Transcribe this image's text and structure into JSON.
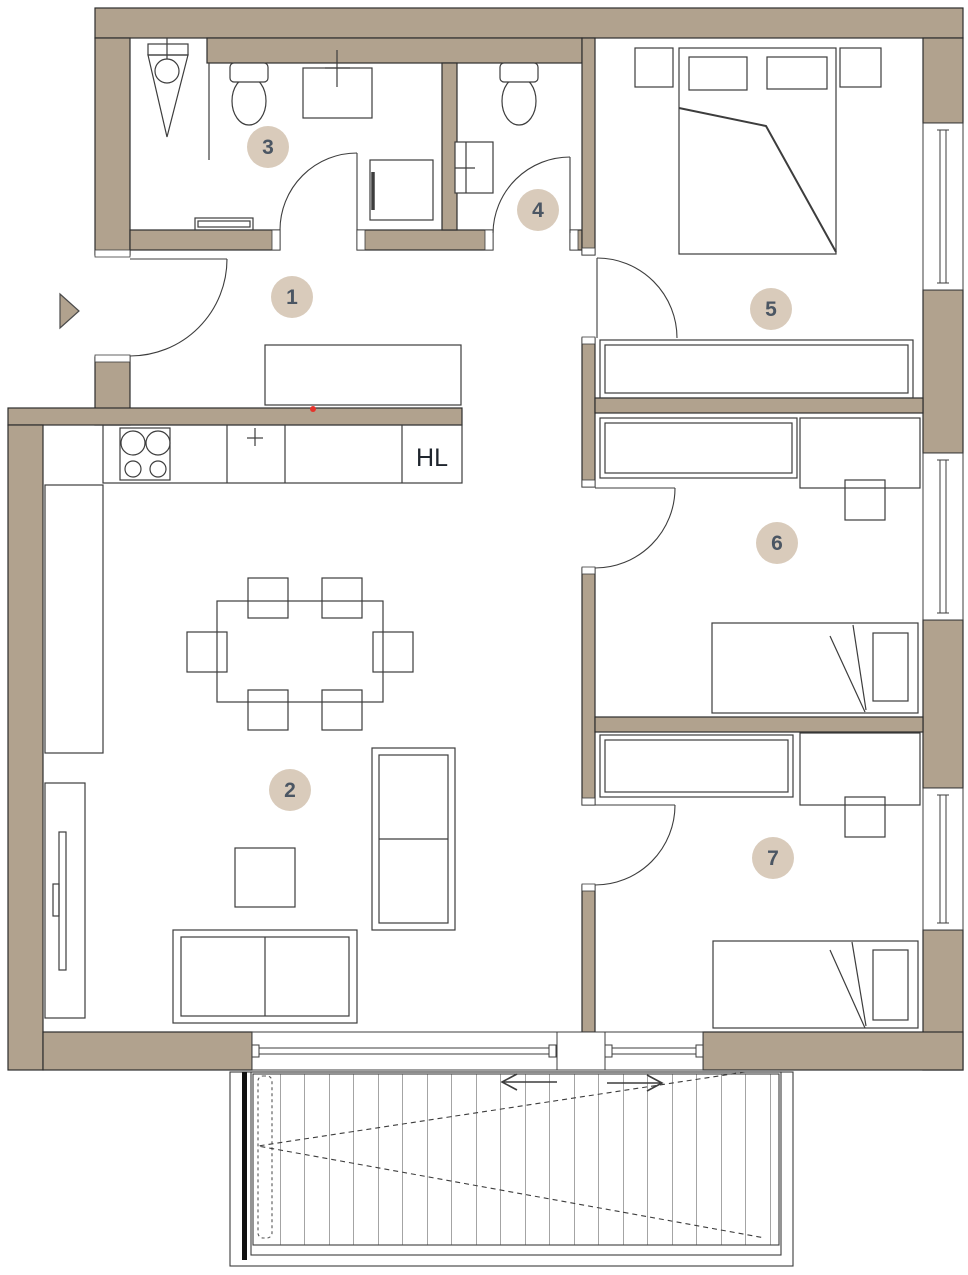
{
  "document": {
    "type": "apartment-floor-plan"
  },
  "rooms": [
    {
      "number": "1"
    },
    {
      "number": "2"
    },
    {
      "number": "3"
    },
    {
      "number": "4"
    },
    {
      "number": "5"
    },
    {
      "number": "6"
    },
    {
      "number": "7"
    }
  ],
  "labels": {
    "shaft": "HL"
  },
  "icons": {
    "entrance_arrow": "right-pointing-triangle",
    "red_marker": "small-red-dot"
  },
  "colors": {
    "wall": "#b1a28e",
    "line": "#3d3d3d",
    "wall_outline": "#2d2d2d",
    "badge_fill": "#d9cbbb",
    "badge_text": "#4b5663",
    "red_marker": "#e5332b",
    "background": "#ffffff"
  }
}
